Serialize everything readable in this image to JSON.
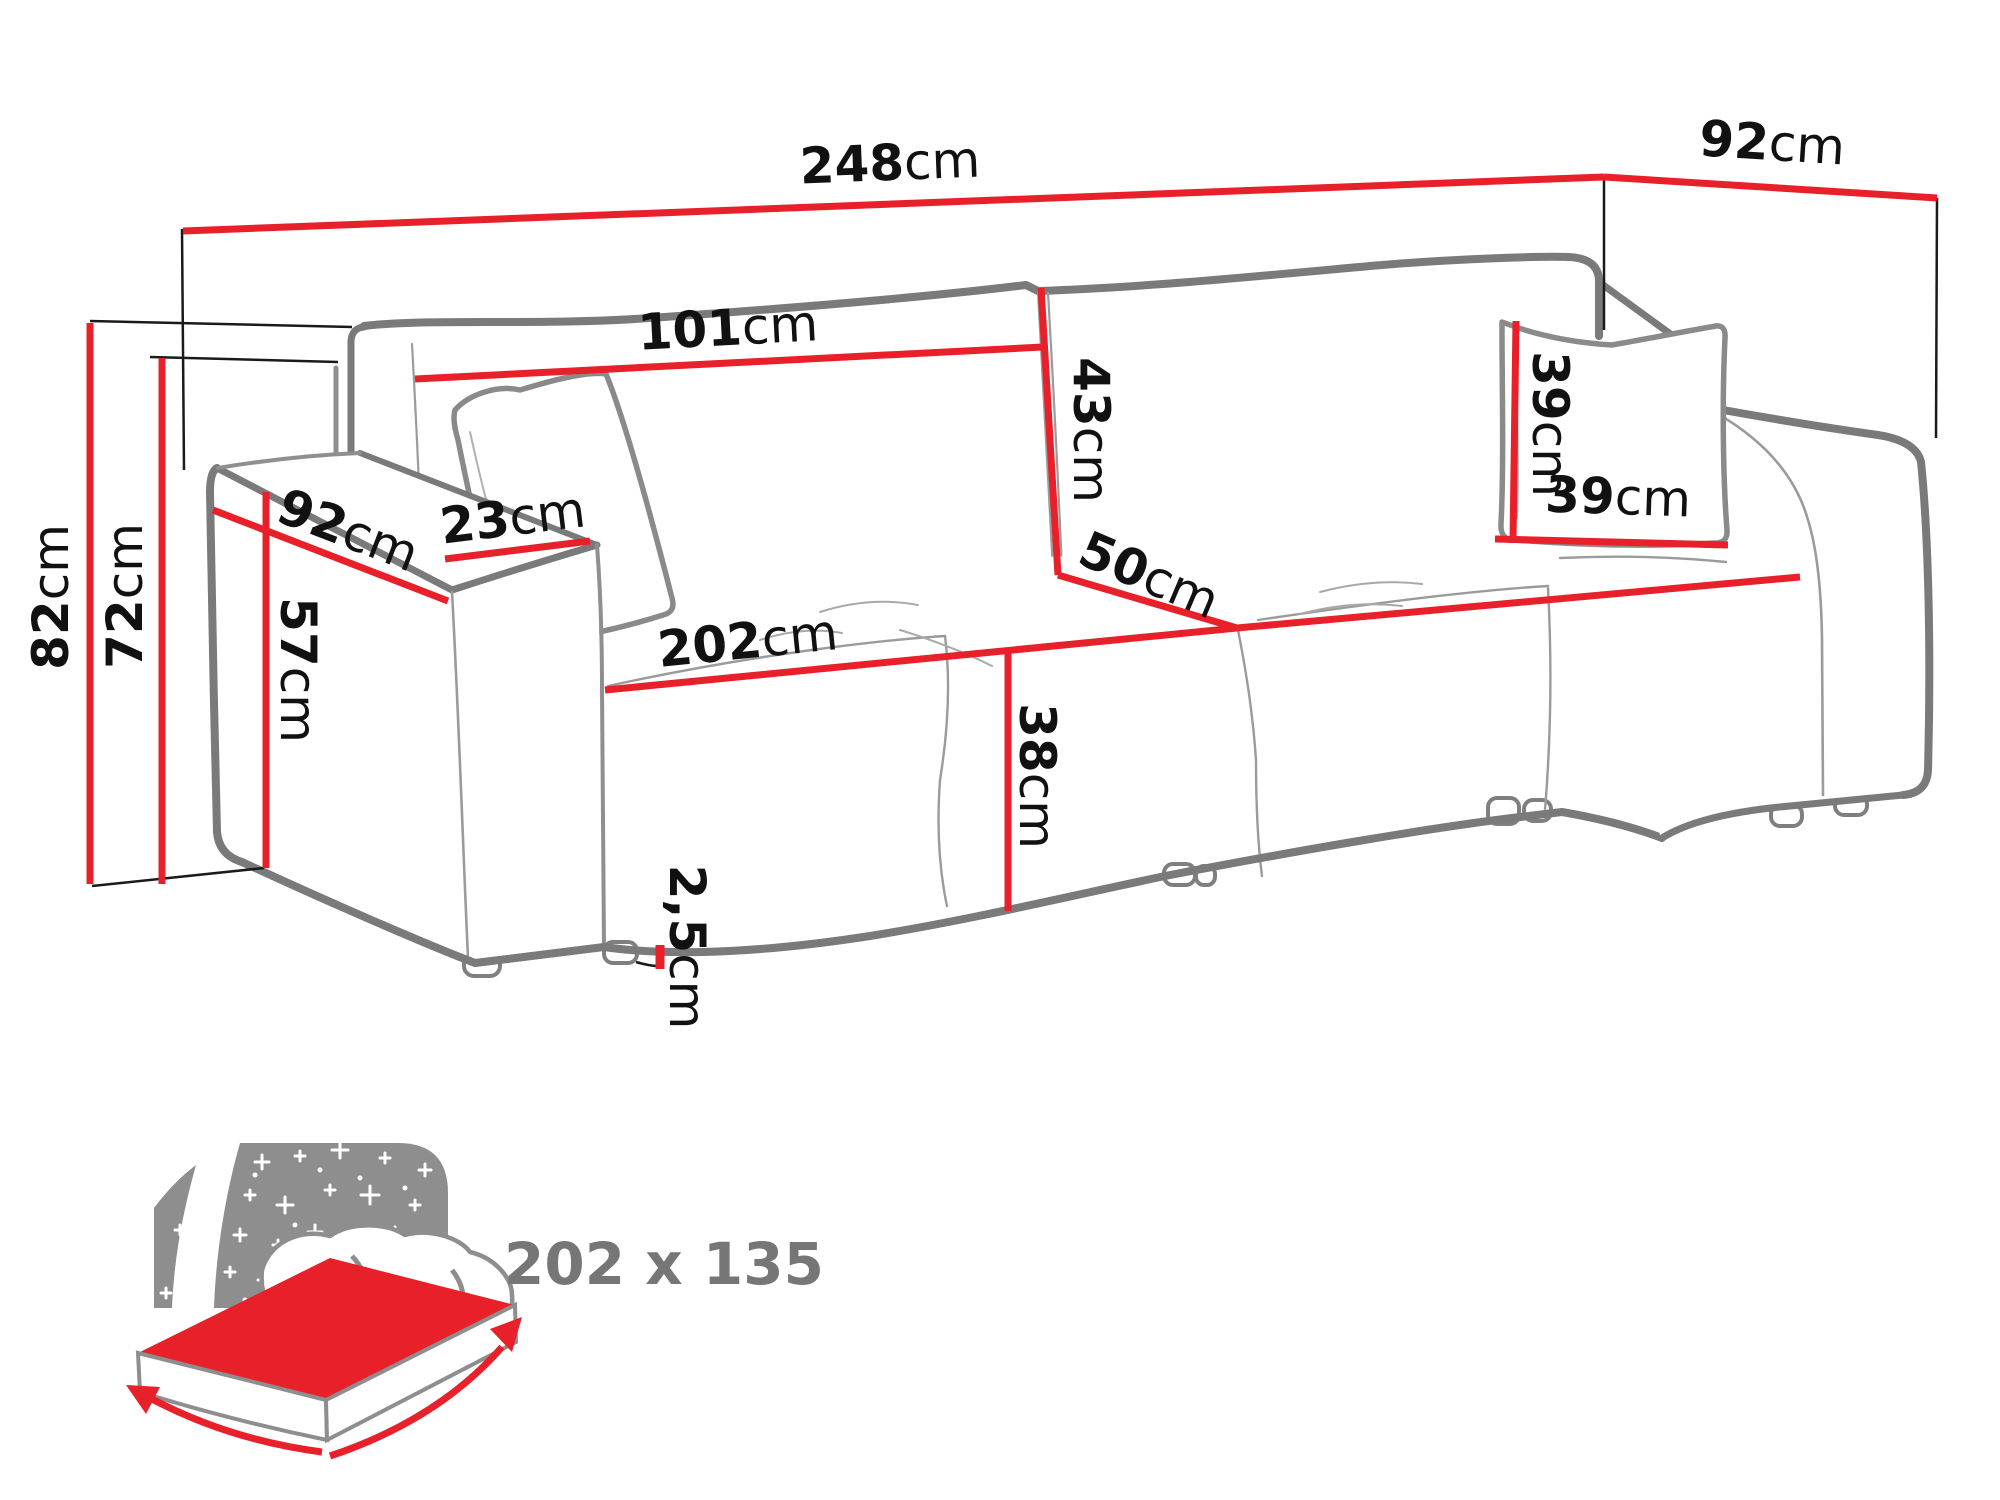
{
  "diagram_title": "sofa-dimensions-diagram",
  "dimensions": {
    "total_width": {
      "value": "248",
      "unit": "cm"
    },
    "total_depth": {
      "value": "92",
      "unit": "cm"
    },
    "backrest_cushion_width": {
      "value": "101",
      "unit": "cm"
    },
    "backrest_cushion_height": {
      "value": "43",
      "unit": "cm"
    },
    "seat_depth": {
      "value": "50",
      "unit": "cm"
    },
    "pillow_height": {
      "value": "39",
      "unit": "cm"
    },
    "pillow_width": {
      "value": "39",
      "unit": "cm"
    },
    "armrest_depth": {
      "value": "92",
      "unit": "cm"
    },
    "armrest_width": {
      "value": "23",
      "unit": "cm"
    },
    "armrest_height": {
      "value": "57",
      "unit": "cm"
    },
    "total_height": {
      "value": "82",
      "unit": "cm"
    },
    "backrest_height": {
      "value": "72",
      "unit": "cm"
    },
    "seat_width": {
      "value": "202",
      "unit": "cm"
    },
    "seat_height": {
      "value": "38",
      "unit": "cm"
    },
    "leg_height": {
      "value": "2,5",
      "unit": "cm"
    }
  },
  "sleeping_function": {
    "size_label": "202 x 135"
  },
  "colors": {
    "dimension_red": "#e8202a",
    "outline_gray": "#7a7a7a",
    "icon_gray": "#8e8e8e",
    "size_text_gray": "#767676",
    "label_black": "#111111"
  }
}
